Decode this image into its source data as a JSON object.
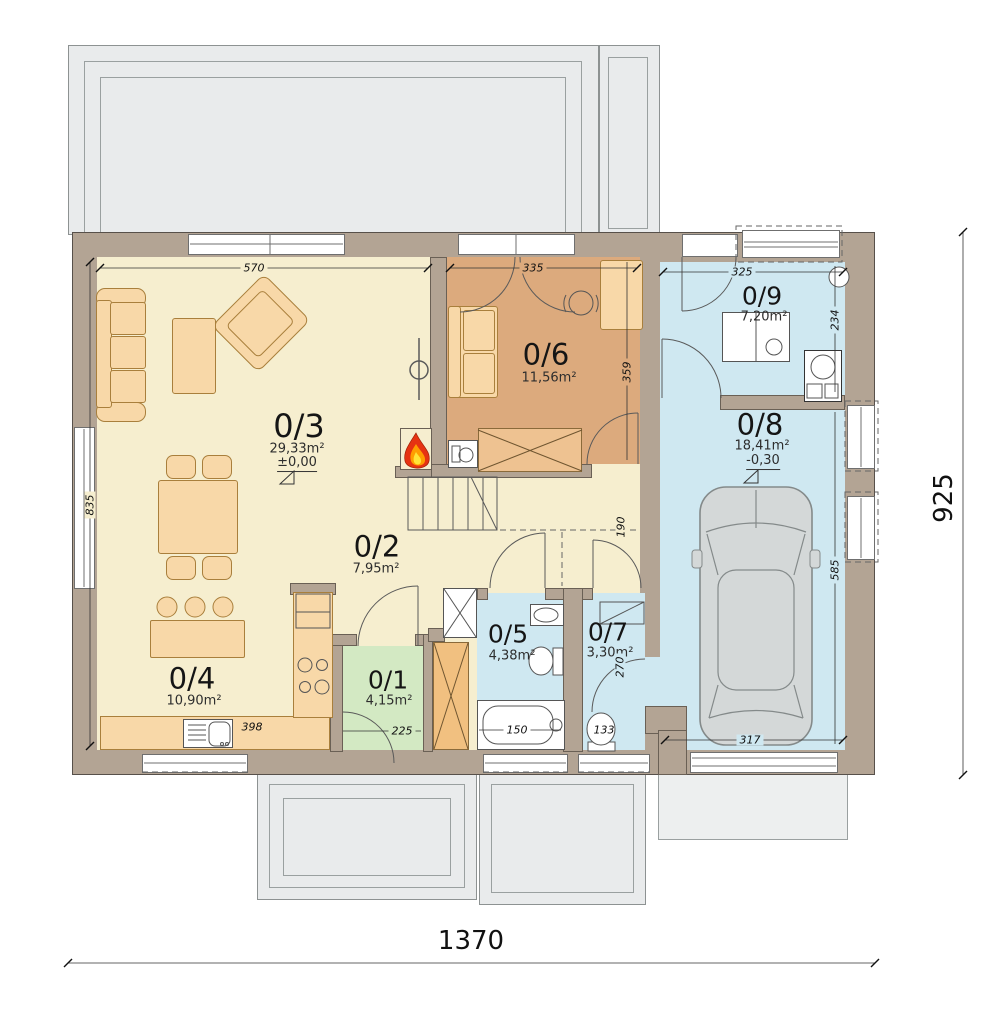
{
  "plan": {
    "rooms": {
      "r3": {
        "id": "0/3",
        "area": "29,33m²",
        "level": "±0,00"
      },
      "r2": {
        "id": "0/2",
        "area": "7,95m²"
      },
      "r4": {
        "id": "0/4",
        "area": "10,90m²"
      },
      "r6": {
        "id": "0/6",
        "area": "11,56m²"
      },
      "r9": {
        "id": "0/9",
        "area": "7,20m²"
      },
      "r8": {
        "id": "0/8",
        "area": "18,41m²",
        "level": "-0,30"
      },
      "r1": {
        "id": "0/1",
        "area": "4,15m²"
      },
      "r5": {
        "id": "0/5",
        "area": "4,38m²"
      },
      "r7": {
        "id": "0/7",
        "area": "3,30m²"
      }
    },
    "dims": {
      "overall_width": "1370",
      "overall_height": "925",
      "d570": "570",
      "d335": "335",
      "d325": "325",
      "d835": "835",
      "d359": "359",
      "d234": "234",
      "d585": "585",
      "d317": "317",
      "d398": "398",
      "d225": "225",
      "d150": "150",
      "d133": "133",
      "d270": "270",
      "d190": "190"
    },
    "colors": {
      "wall": "#b3a494",
      "living_cream": "#f6eecf",
      "room_brown": "#dcaa7d",
      "room_blue": "#cfe8f1",
      "room_green": "#d3e9c3",
      "furniture_peach": "#f8d8a8",
      "wardrobe_orange": "#f1c080",
      "terrace_gray": "#e9ebec",
      "flame_orange": "#e63312"
    }
  }
}
